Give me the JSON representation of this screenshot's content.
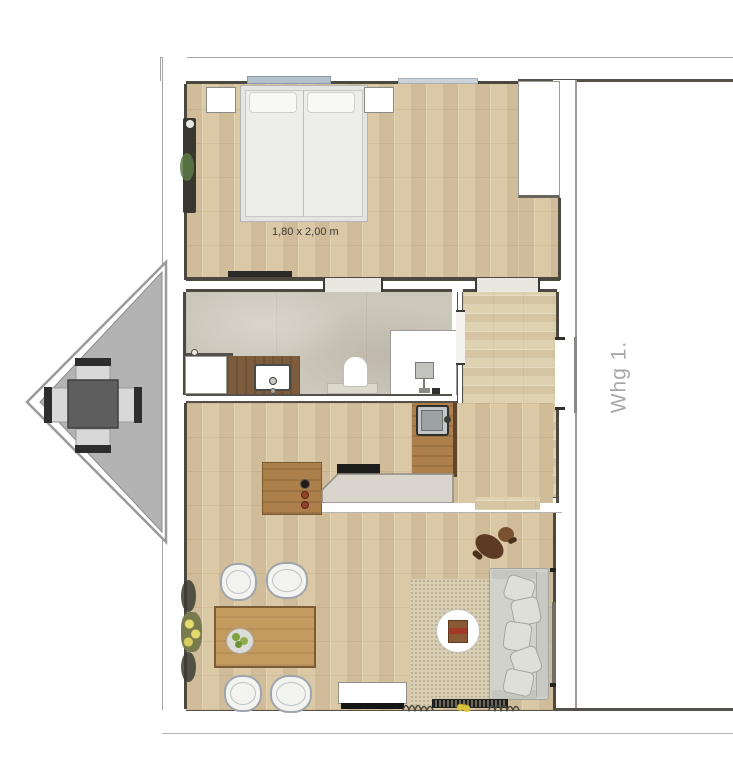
{
  "floor_plan": {
    "labels": {
      "bed_dimensions": "1,80 x 2,00 m",
      "apartment": "Whg 1."
    },
    "colors": {
      "background": "#ffffff",
      "wood_floor": "#d7c5a2",
      "hallway_floor": "#dccfae",
      "bathroom_tile": "#ccc7bb",
      "wall_fill": "#ffffff",
      "wall_edge": "#4c473f",
      "balcony_floor": "#b3b3b3",
      "balcony_table": "#5e5e5e",
      "kitchen_island_wood": "#ad7f4a",
      "vanity_wood": "#7d5c3e",
      "kitchen_counter": "#d9d5cc",
      "cooktop": "#1d1d1b",
      "window_glass": "#b3c1cc",
      "sofa": "#d2d2cc",
      "rug": "#d9cfb5",
      "dining_table": "#c39a60",
      "person_clothes": "#99525c",
      "dog": "#5d3a24",
      "bed_label_text": "#3b3b3b",
      "apartment_label_text": "#a8a8a8"
    }
  }
}
